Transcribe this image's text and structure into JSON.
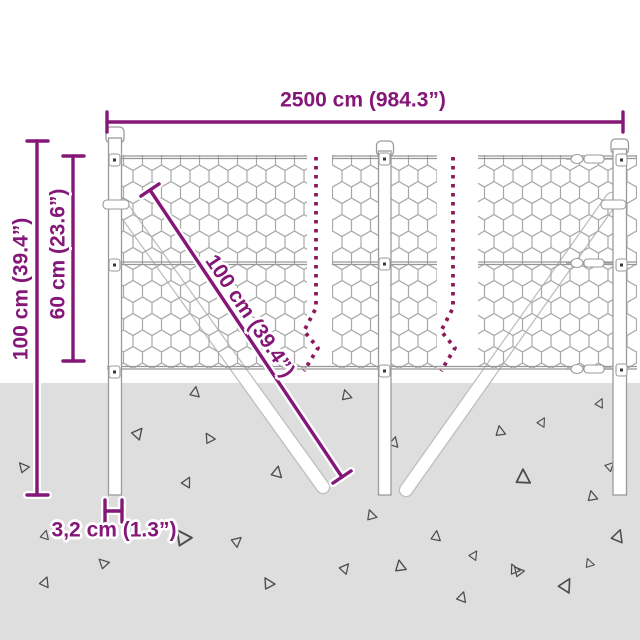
{
  "diagram": {
    "title": "wire-mesh-fence-dimensions",
    "labels": {
      "total_width": "2500 cm (984.3”)",
      "total_height": "100 cm (39.4”)",
      "mesh_height": "60 cm (23.6”)",
      "diagonal_length": "100 cm (39.4”)",
      "post_width": "3,2 cm (1.3”)"
    },
    "colors": {
      "dimension": "#841777",
      "break_dash": "#8e1858",
      "ground": "#dedede",
      "wire": "#a8a8a8",
      "steel_outline": "#9a9a9a",
      "triangle": "#4d4d4d"
    },
    "ground": {
      "triangles": [
        {
          "x": 195,
          "y": 392,
          "s": 0.9,
          "r": 10
        },
        {
          "x": 346,
          "y": 395,
          "s": 0.9,
          "r": -15
        },
        {
          "x": 600,
          "y": 403,
          "s": 0.8,
          "r": 25
        },
        {
          "x": 138,
          "y": 433,
          "s": 1.0,
          "r": 40
        },
        {
          "x": 209,
          "y": 438,
          "s": 0.9,
          "r": -30
        },
        {
          "x": 394,
          "y": 442,
          "s": 0.9,
          "r": 15
        },
        {
          "x": 500,
          "y": 431,
          "s": 0.9,
          "r": -10
        },
        {
          "x": 542,
          "y": 422,
          "s": 0.8,
          "r": 30
        },
        {
          "x": 23,
          "y": 467,
          "s": 0.9,
          "r": -40
        },
        {
          "x": 277,
          "y": 472,
          "s": 1.0,
          "r": 12
        },
        {
          "x": 523,
          "y": 477,
          "s": 1.3,
          "r": 0
        },
        {
          "x": 187,
          "y": 482,
          "s": 0.9,
          "r": 28
        },
        {
          "x": 371,
          "y": 515,
          "s": 0.9,
          "r": -18
        },
        {
          "x": 436,
          "y": 536,
          "s": 0.9,
          "r": 8
        },
        {
          "x": 182,
          "y": 537,
          "s": 1.4,
          "r": -35
        },
        {
          "x": 237,
          "y": 541,
          "s": 0.9,
          "r": 50
        },
        {
          "x": 592,
          "y": 496,
          "s": 0.9,
          "r": -12
        },
        {
          "x": 618,
          "y": 536,
          "s": 1.1,
          "r": 20
        },
        {
          "x": 514,
          "y": 569,
          "s": 0.9,
          "r": -25
        },
        {
          "x": 474,
          "y": 555,
          "s": 0.8,
          "r": 33
        },
        {
          "x": 103,
          "y": 563,
          "s": 0.9,
          "r": -45
        },
        {
          "x": 45,
          "y": 535,
          "s": 0.8,
          "r": 15
        },
        {
          "x": 45,
          "y": 582,
          "s": 0.9,
          "r": 22
        },
        {
          "x": 268,
          "y": 583,
          "s": 1.0,
          "r": -30
        },
        {
          "x": 345,
          "y": 568,
          "s": 0.9,
          "r": 40
        },
        {
          "x": 400,
          "y": 566,
          "s": 1.0,
          "r": -10
        },
        {
          "x": 462,
          "y": 597,
          "s": 0.9,
          "r": 18
        },
        {
          "x": 518,
          "y": 571,
          "s": 0.9,
          "r": -40
        },
        {
          "x": 566,
          "y": 585,
          "s": 1.2,
          "r": 30
        },
        {
          "x": 589,
          "y": 563,
          "s": 0.8,
          "r": -20
        },
        {
          "x": 610,
          "y": 466,
          "s": 0.8,
          "r": 45
        }
      ]
    }
  }
}
